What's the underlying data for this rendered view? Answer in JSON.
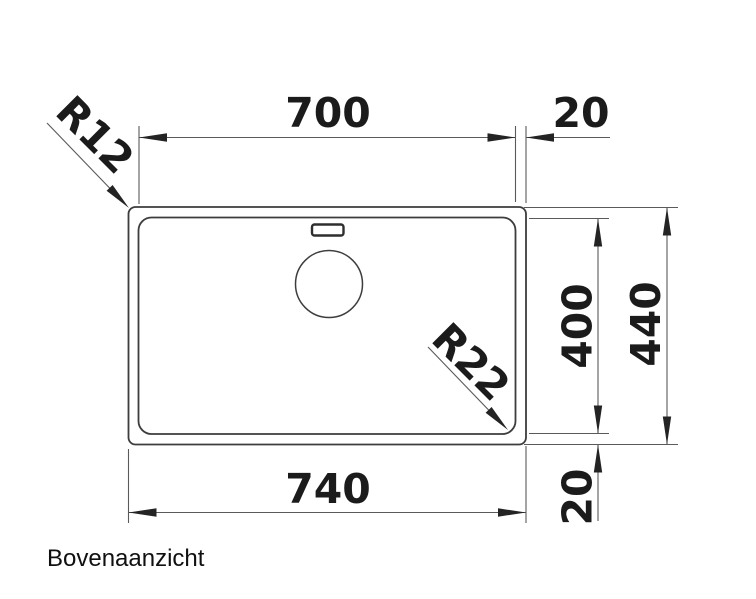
{
  "drawing": {
    "caption": "Bovenaanzicht",
    "dims": {
      "inner_width": "700",
      "rim_offset_top": "20",
      "outer_width": "740",
      "rim_offset_bottom": "20",
      "inner_height": "400",
      "outer_height": "440",
      "outer_corner_radius": "R12",
      "inner_corner_radius": "R22"
    },
    "colors": {
      "object_line": "#3d3d3d",
      "dimension_line": "#5a5a5a",
      "text": "#1b1b1b",
      "background": "#ffffff"
    }
  }
}
